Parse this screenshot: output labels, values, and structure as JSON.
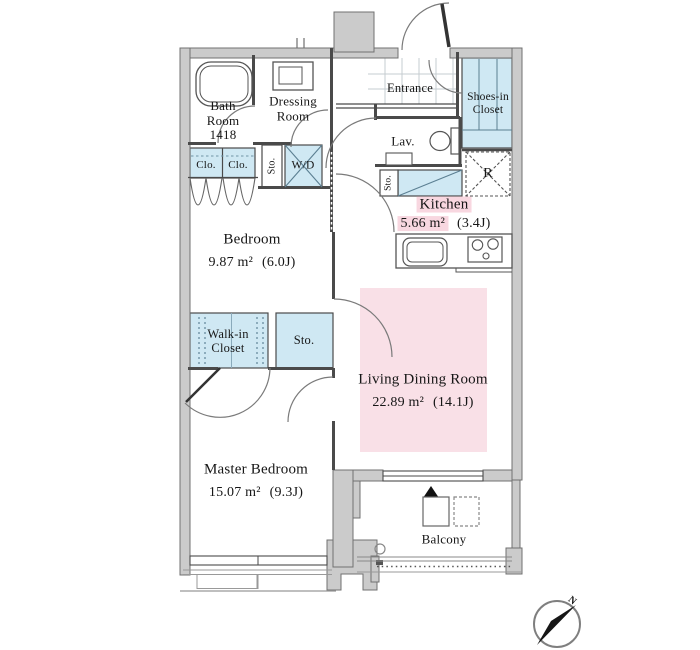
{
  "floorplan": {
    "rooms": {
      "bath": {
        "line1": "Bath",
        "line2": "Room",
        "line3": "1418"
      },
      "dressing": {
        "line1": "Dressing",
        "line2": "Room"
      },
      "entrance": {
        "label": "Entrance"
      },
      "shoes_closet": {
        "line1": "Shoes-in",
        "line2": "Closet"
      },
      "lavatory": {
        "label": "Lav."
      },
      "storage_hall": {
        "label": "Sto."
      },
      "washer_dryer": {
        "label": "W/D"
      },
      "closet_left": {
        "label": "Clo."
      },
      "closet_right": {
        "label": "Clo."
      },
      "storage_kitchen": {
        "label": "Sto."
      },
      "refrigerator": {
        "label": "R"
      },
      "kitchen": {
        "label": "Kitchen",
        "area": "5.66 m²",
        "tatami": "(3.4J)"
      },
      "bedroom": {
        "label": "Bedroom",
        "area": "9.87 m²",
        "tatami": "(6.0J)"
      },
      "walk_in_closet": {
        "line1": "Walk-in",
        "line2": "Closet"
      },
      "storage_ld": {
        "label": "Sto."
      },
      "living_dining": {
        "label": "Living Dining Room",
        "area": "22.89 m²",
        "tatami": "(14.1J)"
      },
      "master_bedroom": {
        "label": "Master Bedroom",
        "area": "15.07 m²",
        "tatami": "(9.3J)"
      },
      "balcony": {
        "label": "Balcony"
      }
    },
    "compass": {
      "north_label": "N"
    },
    "colors": {
      "wall": "#cbcbcb",
      "accent_blue": "#cfe8f3",
      "accent_pink": "#f9e0e7",
      "highlight_pink": "#f8d7e0"
    }
  }
}
